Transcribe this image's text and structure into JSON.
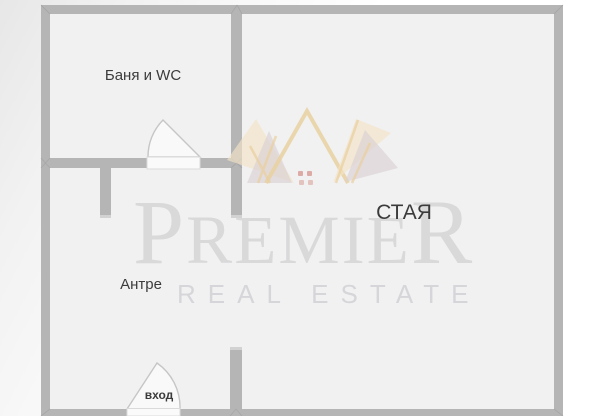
{
  "plan": {
    "rooms": [
      {
        "id": "bathroom",
        "label": "Баня и WC"
      },
      {
        "id": "room",
        "label": "СТАЯ"
      },
      {
        "id": "hallway",
        "label": "Антре"
      },
      {
        "id": "entrance",
        "label": "вход"
      }
    ],
    "colors": {
      "wall": "#b5b5b5",
      "floor": "#f1f1f1",
      "label_text": "#3b3b3b",
      "door_sill": "#fafafa",
      "door_arc": "#c6c6c6"
    }
  },
  "watermark": {
    "brand_first": "P",
    "brand_middle": "REMIE",
    "brand_last": "R",
    "tagline": "REAL ESTATE",
    "colors": {
      "crown_gold": "#e9cf9c",
      "crown_cream": "#f2e3c6",
      "crown_mauve": "#d8ced3",
      "crown_dots": "#d79a94",
      "text": "#dfdfdf"
    }
  }
}
